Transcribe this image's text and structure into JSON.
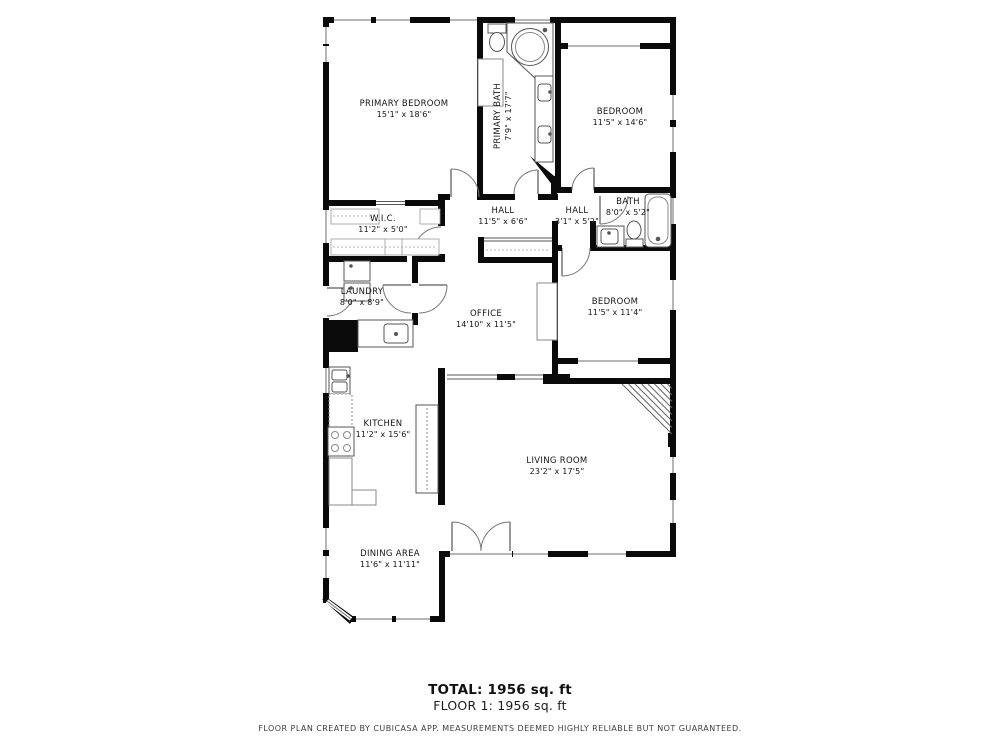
{
  "rooms": {
    "primary_bedroom": {
      "name": "PRIMARY BEDROOM",
      "dims": "15'1\" x 18'6\""
    },
    "primary_bath": {
      "name": "PRIMARY BATH",
      "dims": "7'9\" x 17'7\""
    },
    "bedroom_top": {
      "name": "BEDROOM",
      "dims": "11'5\" x 14'6\""
    },
    "wic": {
      "name": "W.I.C.",
      "dims": "11'2\" x 5'0\""
    },
    "hall_main": {
      "name": "HALL",
      "dims": "11'5\" x 6'6\""
    },
    "hall_small": {
      "name": "HALL",
      "dims": "3'1\" x 5'2\""
    },
    "bath": {
      "name": "BATH",
      "dims": "8'0\" x 5'2\""
    },
    "laundry": {
      "name": "LAUNDRY",
      "dims": "8'0\" x 8'9\""
    },
    "office": {
      "name": "OFFICE",
      "dims": "14'10\" x 11'5\""
    },
    "bedroom_mid": {
      "name": "BEDROOM",
      "dims": "11'5\" x 11'4\""
    },
    "kitchen": {
      "name": "KITCHEN",
      "dims": "11'2\" x 15'6\""
    },
    "living_room": {
      "name": "LIVING ROOM",
      "dims": "23'2\" x 17'5\""
    },
    "dining_area": {
      "name": "DINING AREA",
      "dims": "11'6\" x 11'11\""
    }
  },
  "summary": {
    "total": "TOTAL: 1956 sq. ft",
    "floor1": "FLOOR 1: 1956 sq. ft"
  },
  "footer": {
    "disclaimer": "FLOOR PLAN CREATED BY CUBICASA APP. MEASUREMENTS DEEMED HIGHLY RELIABLE BUT NOT GUARANTEED."
  },
  "colors": {
    "wall": "#0a0a0a",
    "thin_line": "#555555",
    "light_line": "#8a8a8a",
    "text": "#141414"
  }
}
